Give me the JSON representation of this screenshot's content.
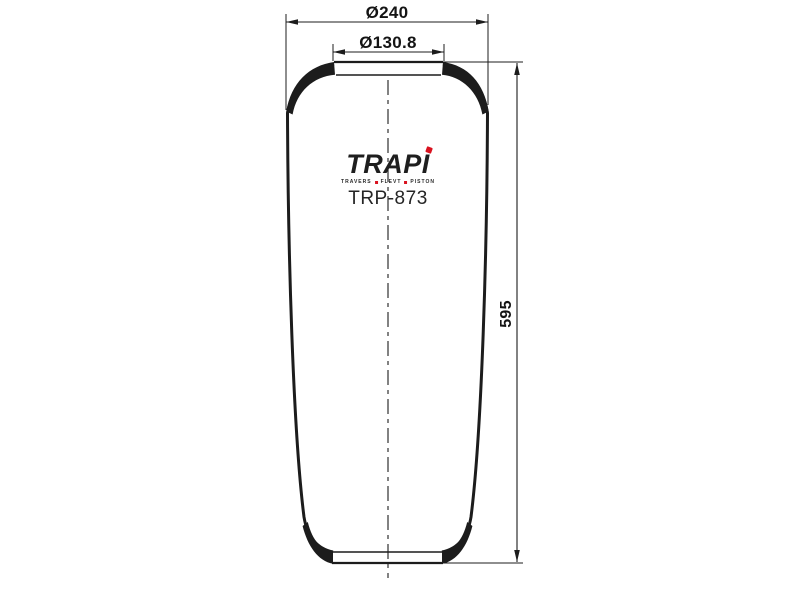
{
  "drawing": {
    "labels": {
      "outer_diameter": "Ø240",
      "top_diameter": "Ø130.8",
      "overall_height": "595"
    },
    "brand": {
      "logo": "TRAPI",
      "tagline_words": [
        "TRAVERS",
        "FLEVT",
        "PISTON"
      ],
      "part_number": "TRP-873"
    },
    "colors": {
      "line": "#1c1c1c",
      "background": "#ffffff",
      "accent_red": "#d9121f",
      "dimension_text": "#141414"
    }
  }
}
